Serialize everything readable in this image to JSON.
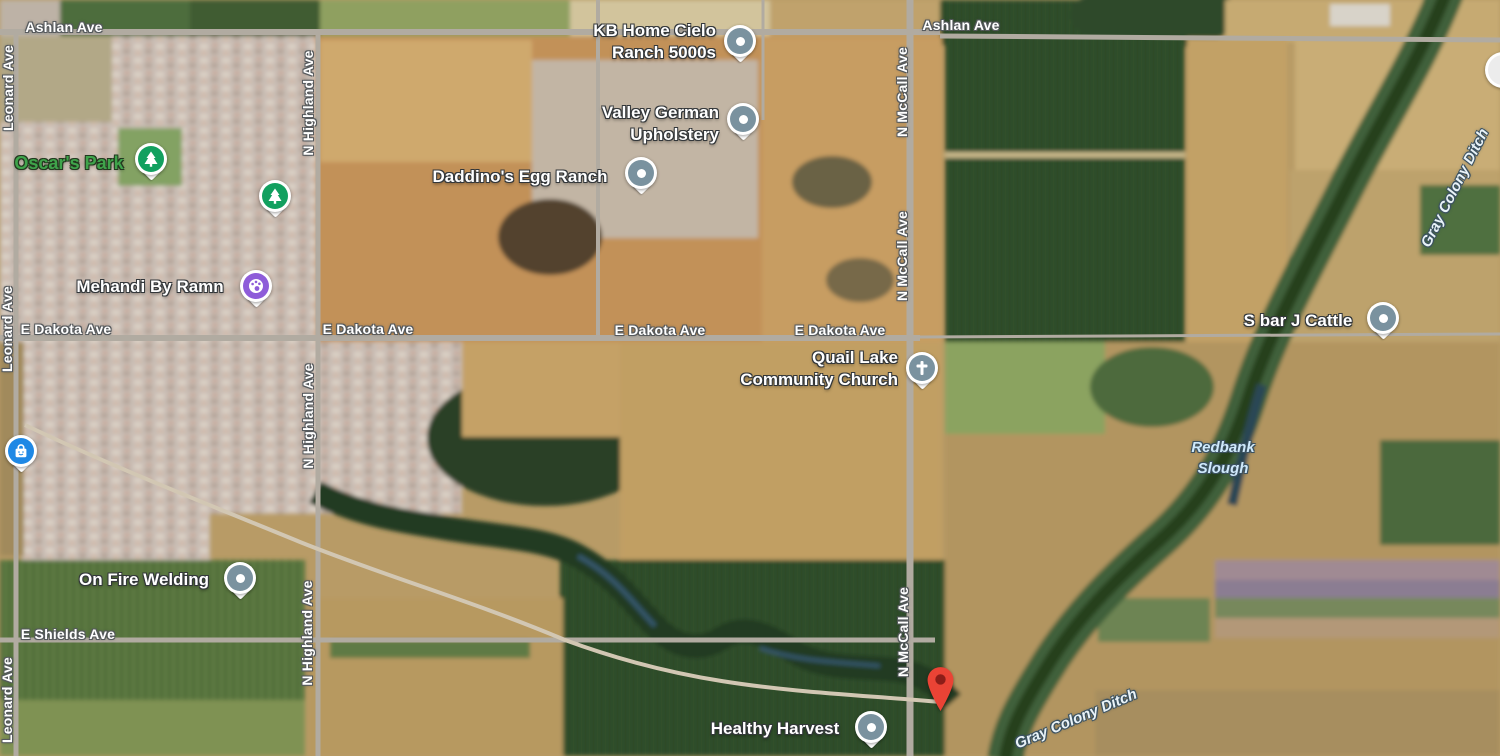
{
  "map": {
    "view_type": "satellite",
    "road_labels": [
      {
        "text": "Ashlan Ave",
        "x": 64,
        "y": 27,
        "orientation": "horizontal"
      },
      {
        "text": "Ashlan Ave",
        "x": 961,
        "y": 25,
        "orientation": "horizontal"
      },
      {
        "text": "E Dakota Ave",
        "x": 66,
        "y": 329,
        "orientation": "horizontal"
      },
      {
        "text": "E Dakota Ave",
        "x": 368,
        "y": 329,
        "orientation": "horizontal"
      },
      {
        "text": "E Dakota Ave",
        "x": 660,
        "y": 330,
        "orientation": "horizontal"
      },
      {
        "text": "E Dakota Ave",
        "x": 840,
        "y": 330,
        "orientation": "horizontal"
      },
      {
        "text": "E Shields Ave",
        "x": 68,
        "y": 634,
        "orientation": "horizontal"
      },
      {
        "text": "Leonard Ave",
        "x": 8,
        "y": 88,
        "orientation": "vertical"
      },
      {
        "text": "Leonard Ave",
        "x": 7,
        "y": 329,
        "orientation": "vertical"
      },
      {
        "text": "Leonard Ave",
        "x": 7,
        "y": 700,
        "orientation": "vertical"
      },
      {
        "text": "N Highland Ave",
        "x": 308,
        "y": 103,
        "orientation": "vertical"
      },
      {
        "text": "N Highland Ave",
        "x": 308,
        "y": 416,
        "orientation": "vertical"
      },
      {
        "text": "N Highland Ave",
        "x": 307,
        "y": 633,
        "orientation": "vertical"
      },
      {
        "text": "N McCall Ave",
        "x": 902,
        "y": 92,
        "orientation": "vertical"
      },
      {
        "text": "N McCall Ave",
        "x": 902,
        "y": 256,
        "orientation": "vertical"
      },
      {
        "text": "N McCall Ave",
        "x": 903,
        "y": 632,
        "orientation": "vertical"
      }
    ],
    "water_labels": [
      {
        "text": "Redbank Slough",
        "lines": [
          "Redbank",
          "Slough"
        ],
        "x": 1223,
        "y": 458,
        "rotation": 0
      },
      {
        "text": "Gray Colony Ditch",
        "x": 1455,
        "y": 188,
        "rotation": -63
      },
      {
        "text": "Gray Colony Ditch",
        "x": 1076,
        "y": 719,
        "rotation": -23
      }
    ],
    "pois": [
      {
        "name": "Oscar's Park",
        "lines": [
          "Oscar's Park"
        ],
        "pin": {
          "type": "park-tree",
          "x": 151,
          "y": 159
        }
      },
      {
        "name": "KB Home Cielo Ranch 5000s",
        "lines": [
          "KB Home Cielo",
          "Ranch 5000s"
        ],
        "pin": {
          "type": "generic-dot",
          "x": 740,
          "y": 41
        }
      },
      {
        "name": "Valley German Upholstery",
        "lines": [
          "Valley German",
          "Upholstery"
        ],
        "pin": {
          "type": "generic-dot",
          "x": 743,
          "y": 119
        }
      },
      {
        "name": "Daddino's Egg Ranch",
        "lines": [
          "Daddino's Egg Ranch"
        ],
        "pin": {
          "type": "generic-dot",
          "x": 641,
          "y": 173
        }
      },
      {
        "name": "Mehandi By Ramn",
        "lines": [
          "Mehandi By Ramn"
        ],
        "pin": {
          "type": "beauty-palette",
          "x": 256,
          "y": 286
        }
      },
      {
        "name": "Quail Lake Community Church",
        "lines": [
          "Quail Lake",
          "Community Church"
        ],
        "pin": {
          "type": "church-cross",
          "x": 922,
          "y": 368
        }
      },
      {
        "name": "S bar J Cattle",
        "lines": [
          "S bar J Cattle"
        ],
        "pin": {
          "type": "generic-dot",
          "x": 1383,
          "y": 318
        }
      },
      {
        "name": "On Fire Welding",
        "lines": [
          "On Fire Welding"
        ],
        "pin": {
          "type": "generic-dot",
          "x": 240,
          "y": 578
        }
      },
      {
        "name": "Healthy Harvest",
        "lines": [
          "Healthy Harvest"
        ],
        "pin": {
          "type": "generic-dot",
          "x": 871,
          "y": 727
        }
      }
    ],
    "markers": {
      "destination": {
        "type": "red-marker",
        "x": 940,
        "y": 712
      },
      "shopping_pin": {
        "type": "blue-shopping-bag",
        "x": 21,
        "y": 451
      },
      "extra_park_pin": {
        "type": "park-tree",
        "x": 275,
        "y": 196
      },
      "partial_pin_right_edge": {
        "type": "white-pin-clipped",
        "x": 1503,
        "y": 70
      }
    },
    "colors": {
      "generic_poi_pin": "#7a929f",
      "park_pin": "#12a05f",
      "beauty_pin": "#8e5cd9",
      "shopping_pin": "#1e88e5",
      "church_pin": "#7a929f",
      "destination_pin": "#ea4335",
      "destination_pin_inner": "#8c1d18",
      "road_label": "#ffffff",
      "park_label": "#3fa44b",
      "water_label": "#cfe9fb"
    }
  }
}
